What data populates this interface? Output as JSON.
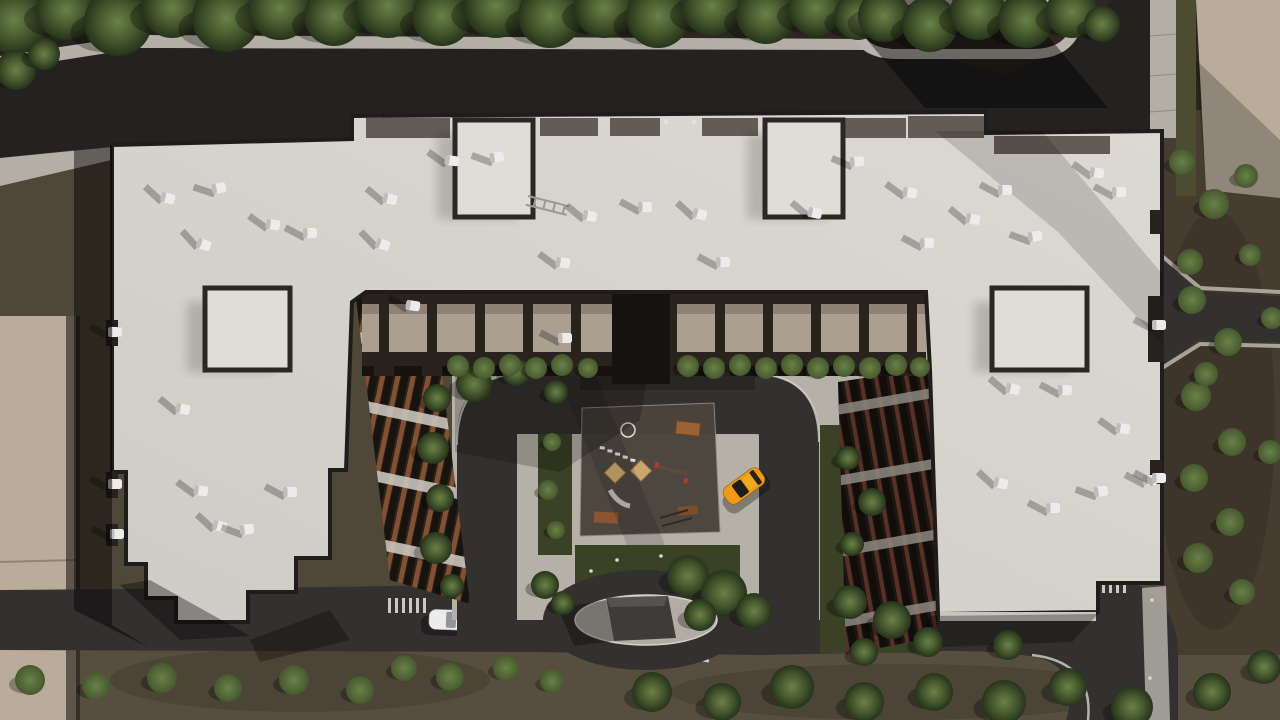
{
  "scene": {
    "description": "Aerial top-down 3D architectural render of a U-shaped residential apartment complex with light flat roofs, rooftop vents, an inner courtyard with playground, loop road, oval entrance island with a dark parking-ramp pavilion, an orange hatchback in the courtyard, a white car on the south road, asphalt streets and rows of trees",
    "colors": {
      "ground": "#4f4738",
      "groundTop": "#2c2720",
      "groundBottom": "#574e3f",
      "roadTop": "#232221",
      "road": "#333130",
      "sidewalk": "#b3afa7",
      "curb": "#d6d2ca",
      "roofEdge": "#1f1d1b",
      "roofHi": "#dcd9d3",
      "roofLo": "#cfccc5",
      "plaza": "#b5b1a8",
      "plazaShade": "#9d9992",
      "lawn": "#3a4124",
      "playground": "#4a443d",
      "sand": "#caa76e",
      "wood": "#9b6233",
      "beige": "#b9ac9b",
      "hedge": "#4b4c30",
      "carOrange": "#ef9a12",
      "carWhite": "#ececea",
      "pavilion": "#3d3c39",
      "ventWhite": "#ececea",
      "brick": "#84502f",
      "facadeDark": "#2a231d",
      "facadeBand": "#c9c4bb",
      "balcony": "#ab9f90",
      "treeHi": "#6a8148",
      "treeMid": "#46592e",
      "treeLo": "#26331b"
    },
    "objects": {
      "building": "u-shaped-residential-block",
      "playground": "children-playground",
      "roundabout": "oval-island-with-parking-ramp-pavilion",
      "car_courtyard": "orange-hatchback",
      "car_road": "white-car"
    },
    "vents": [
      [
        163,
        197,
        15
      ],
      [
        214,
        189,
        -10
      ],
      [
        268,
        224,
        8
      ],
      [
        199,
        243,
        20
      ],
      [
        305,
        233,
        0
      ],
      [
        385,
        198,
        12
      ],
      [
        378,
        243,
        18
      ],
      [
        178,
        408,
        12
      ],
      [
        196,
        490,
        8
      ],
      [
        285,
        492,
        0
      ],
      [
        215,
        525,
        15
      ],
      [
        242,
        530,
        -8
      ],
      [
        447,
        160,
        8
      ],
      [
        492,
        158,
        -8
      ],
      [
        585,
        215,
        12
      ],
      [
        640,
        207,
        0
      ],
      [
        695,
        213,
        15
      ],
      [
        558,
        262,
        8
      ],
      [
        718,
        262,
        0
      ],
      [
        810,
        212,
        12
      ],
      [
        852,
        162,
        -5
      ],
      [
        905,
        192,
        8
      ],
      [
        922,
        243,
        0
      ],
      [
        968,
        218,
        12
      ],
      [
        1000,
        190,
        0
      ],
      [
        1092,
        172,
        8
      ],
      [
        1114,
        192,
        0
      ],
      [
        1030,
        237,
        -8
      ],
      [
        1008,
        388,
        12
      ],
      [
        1060,
        390,
        0
      ],
      [
        1118,
        428,
        8
      ],
      [
        996,
        482,
        15
      ],
      [
        1048,
        508,
        0
      ],
      [
        1096,
        492,
        -8
      ],
      [
        1145,
        480,
        0
      ],
      [
        408,
        305,
        8
      ],
      [
        560,
        338,
        0
      ],
      [
        110,
        332,
        0
      ],
      [
        110,
        484,
        0
      ],
      [
        112,
        534,
        0
      ],
      [
        1154,
        325,
        0
      ],
      [
        1154,
        478,
        0
      ]
    ],
    "trees": [
      [
        14,
        20,
        34,
        "t"
      ],
      [
        66,
        10,
        30,
        "t"
      ],
      [
        118,
        22,
        34,
        "t"
      ],
      [
        172,
        8,
        30,
        "t"
      ],
      [
        226,
        18,
        34,
        "t"
      ],
      [
        280,
        8,
        32,
        "t"
      ],
      [
        334,
        16,
        30,
        "t"
      ],
      [
        388,
        6,
        32,
        "t"
      ],
      [
        442,
        16,
        30,
        "t"
      ],
      [
        496,
        6,
        32,
        "t"
      ],
      [
        550,
        16,
        32,
        "t"
      ],
      [
        604,
        8,
        30,
        "t"
      ],
      [
        658,
        16,
        32,
        "t"
      ],
      [
        712,
        6,
        30,
        "t"
      ],
      [
        766,
        14,
        30,
        "t"
      ],
      [
        816,
        8,
        28,
        "t"
      ],
      [
        858,
        16,
        24,
        "t"
      ],
      [
        16,
        70,
        20,
        "t"
      ],
      [
        44,
        54,
        16,
        "t"
      ],
      [
        884,
        16,
        26,
        "t"
      ],
      [
        930,
        24,
        28,
        "t"
      ],
      [
        978,
        12,
        28,
        "t"
      ],
      [
        1026,
        20,
        28,
        "t"
      ],
      [
        1072,
        12,
        26,
        "t"
      ],
      [
        1102,
        24,
        18,
        "t"
      ],
      [
        1182,
        162,
        13,
        "b"
      ],
      [
        1214,
        204,
        15,
        "b"
      ],
      [
        1246,
        176,
        12,
        "b"
      ],
      [
        1190,
        262,
        13,
        "b"
      ],
      [
        1250,
        255,
        11,
        "b"
      ],
      [
        1192,
        300,
        14,
        "b"
      ],
      [
        1228,
        342,
        14,
        "b"
      ],
      [
        1196,
        396,
        15,
        "b"
      ],
      [
        1232,
        442,
        14,
        "b"
      ],
      [
        1194,
        478,
        14,
        "b"
      ],
      [
        1230,
        522,
        14,
        "b"
      ],
      [
        1198,
        558,
        15,
        "b"
      ],
      [
        1242,
        592,
        13,
        "b"
      ],
      [
        1270,
        452,
        12,
        "b"
      ],
      [
        1272,
        318,
        11,
        "b"
      ],
      [
        1206,
        374,
        12,
        "b"
      ],
      [
        30,
        680,
        15,
        "b"
      ],
      [
        96,
        686,
        14,
        "b"
      ],
      [
        162,
        678,
        15,
        "b"
      ],
      [
        228,
        688,
        14,
        "b"
      ],
      [
        294,
        680,
        15,
        "b"
      ],
      [
        360,
        690,
        14,
        "b"
      ],
      [
        404,
        668,
        13,
        "b"
      ],
      [
        450,
        677,
        14,
        "b"
      ],
      [
        506,
        668,
        13,
        "b"
      ],
      [
        552,
        681,
        12,
        "b"
      ],
      [
        652,
        692,
        20,
        "t"
      ],
      [
        722,
        702,
        19,
        "t"
      ],
      [
        792,
        687,
        22,
        "t"
      ],
      [
        864,
        702,
        20,
        "t"
      ],
      [
        934,
        692,
        19,
        "t"
      ],
      [
        1004,
        702,
        22,
        "t"
      ],
      [
        1068,
        687,
        19,
        "t"
      ],
      [
        1132,
        707,
        21,
        "t"
      ],
      [
        1212,
        692,
        19,
        "t"
      ],
      [
        1264,
        667,
        17,
        "t"
      ],
      [
        1008,
        645,
        15,
        "t"
      ],
      [
        437,
        398,
        14,
        "t"
      ],
      [
        433,
        448,
        16,
        "t"
      ],
      [
        440,
        498,
        14,
        "t"
      ],
      [
        436,
        548,
        16,
        "t"
      ],
      [
        452,
        586,
        12,
        "t"
      ],
      [
        474,
        384,
        18,
        "t"
      ],
      [
        516,
        372,
        14,
        "t"
      ],
      [
        556,
        392,
        12,
        "t"
      ],
      [
        458,
        366,
        11,
        "b"
      ],
      [
        484,
        368,
        11,
        "b"
      ],
      [
        510,
        365,
        11,
        "b"
      ],
      [
        536,
        368,
        11,
        "b"
      ],
      [
        562,
        365,
        11,
        "b"
      ],
      [
        588,
        368,
        10,
        "b"
      ],
      [
        688,
        366,
        11,
        "b"
      ],
      [
        714,
        368,
        11,
        "b"
      ],
      [
        740,
        365,
        11,
        "b"
      ],
      [
        766,
        368,
        11,
        "b"
      ],
      [
        792,
        365,
        11,
        "b"
      ],
      [
        818,
        368,
        11,
        "b"
      ],
      [
        844,
        366,
        11,
        "b"
      ],
      [
        870,
        368,
        11,
        "b"
      ],
      [
        896,
        365,
        11,
        "b"
      ],
      [
        920,
        367,
        10,
        "b"
      ],
      [
        552,
        442,
        9,
        "b"
      ],
      [
        548,
        490,
        10,
        "b"
      ],
      [
        556,
        530,
        9,
        "b"
      ],
      [
        688,
        576,
        21,
        "t"
      ],
      [
        724,
        593,
        23,
        "t"
      ],
      [
        754,
        611,
        18,
        "t"
      ],
      [
        700,
        615,
        16,
        "t"
      ],
      [
        848,
        458,
        12,
        "t"
      ],
      [
        872,
        502,
        14,
        "t"
      ],
      [
        852,
        544,
        12,
        "t"
      ],
      [
        850,
        602,
        17,
        "t"
      ],
      [
        892,
        620,
        19,
        "t"
      ],
      [
        928,
        642,
        15,
        "t"
      ],
      [
        864,
        652,
        14,
        "t"
      ],
      [
        545,
        585,
        14,
        "t"
      ],
      [
        563,
        603,
        12,
        "t"
      ]
    ],
    "crosswalks": [
      [
        571,
        388,
        0,
        5,
        "h"
      ],
      [
        698,
        388,
        0,
        5,
        "h"
      ],
      [
        584,
        586,
        14,
        4,
        "h"
      ],
      [
        590,
        640,
        -12,
        4,
        "h"
      ],
      [
        694,
        586,
        -14,
        4,
        "h"
      ],
      [
        696,
        640,
        12,
        4,
        "h"
      ],
      [
        1088,
        578,
        0,
        6,
        "v"
      ],
      [
        388,
        598,
        0,
        6,
        "v"
      ],
      [
        466,
        598,
        0,
        6,
        "v"
      ]
    ],
    "people": [
      [
        617,
        560
      ],
      [
        661,
        556
      ],
      [
        591,
        571
      ],
      [
        1152,
        600
      ],
      [
        1150,
        678
      ]
    ]
  }
}
